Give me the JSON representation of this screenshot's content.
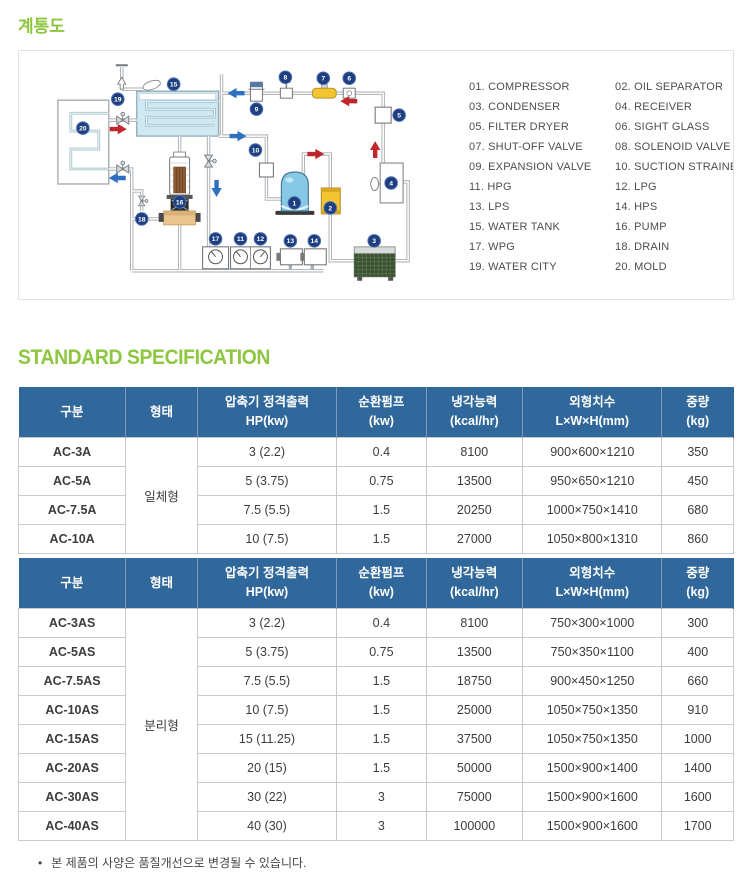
{
  "titles": {
    "diagram": "계통도",
    "spec": "STANDARD SPECIFICATION"
  },
  "colors": {
    "accent_green": "#8dc63f",
    "header_blue": "#31689b",
    "marker_navy": "#1d3f7f",
    "arrow_red": "#c0272d",
    "arrow_blue": "#2e6fc0"
  },
  "legend": {
    "items": [
      {
        "num": "01.",
        "label": "COMPRESSOR"
      },
      {
        "num": "02.",
        "label": "OIL SEPARATOR"
      },
      {
        "num": "03.",
        "label": "CONDENSER"
      },
      {
        "num": "04.",
        "label": "RECEIVER"
      },
      {
        "num": "05.",
        "label": "FILTER DRYER"
      },
      {
        "num": "06.",
        "label": "SIGHT GLASS"
      },
      {
        "num": "07.",
        "label": "SHUT-OFF VALVE"
      },
      {
        "num": "08.",
        "label": "SOLENOID VALVE"
      },
      {
        "num": "09.",
        "label": "EXPANSION VALVE"
      },
      {
        "num": "10.",
        "label": "SUCTION STRAINER"
      },
      {
        "num": "11.",
        "label": "HPG"
      },
      {
        "num": "12.",
        "label": "LPG"
      },
      {
        "num": "13.",
        "label": "LPS"
      },
      {
        "num": "14.",
        "label": "HPS"
      },
      {
        "num": "15.",
        "label": "WATER TANK"
      },
      {
        "num": "16.",
        "label": "PUMP"
      },
      {
        "num": "17.",
        "label": "WPG"
      },
      {
        "num": "18.",
        "label": "DRAIN"
      },
      {
        "num": "19.",
        "label": "WATER CITY"
      },
      {
        "num": "20.",
        "label": "MOLD"
      }
    ]
  },
  "spec": {
    "headers": [
      {
        "line1": "구분",
        "line2": ""
      },
      {
        "line1": "형태",
        "line2": ""
      },
      {
        "line1": "압축기 정격출력",
        "line2": "HP(kw)"
      },
      {
        "line1": "순환펌프",
        "line2": "(kw)"
      },
      {
        "line1": "냉각능력",
        "line2": "(kcal/hr)"
      },
      {
        "line1": "외형치수",
        "line2": "L×W×H(mm)"
      },
      {
        "line1": "중량",
        "line2": "(kg)"
      }
    ],
    "tables": [
      {
        "group": "일체형",
        "rows": [
          [
            "AC-3A",
            "3 (2.2)",
            "0.4",
            "8100",
            "900×600×1210",
            "350"
          ],
          [
            "AC-5A",
            "5 (3.75)",
            "0.75",
            "13500",
            "950×650×1210",
            "450"
          ],
          [
            "AC-7.5A",
            "7.5 (5.5)",
            "1.5",
            "20250",
            "1000×750×1410",
            "680"
          ],
          [
            "AC-10A",
            "10 (7.5)",
            "1.5",
            "27000",
            "1050×800×1310",
            "860"
          ]
        ]
      },
      {
        "group": "분리형",
        "rows": [
          [
            "AC-3AS",
            "3 (2.2)",
            "0.4",
            "8100",
            "750×300×1000",
            "300"
          ],
          [
            "AC-5AS",
            "5 (3.75)",
            "0.75",
            "13500",
            "750×350×1100",
            "400"
          ],
          [
            "AC-7.5AS",
            "7.5 (5.5)",
            "1.5",
            "18750",
            "900×450×1250",
            "660"
          ],
          [
            "AC-10AS",
            "10 (7.5)",
            "1.5",
            "25000",
            "1050×750×1350",
            "910"
          ],
          [
            "AC-15AS",
            "15 (11.25)",
            "1.5",
            "37500",
            "1050×750×1350",
            "1000"
          ],
          [
            "AC-20AS",
            "20 (15)",
            "1.5",
            "50000",
            "1500×900×1400",
            "1400"
          ],
          [
            "AC-30AS",
            "30 (22)",
            "3",
            "75000",
            "1500×900×1600",
            "1600"
          ],
          [
            "AC-40AS",
            "40 (30)",
            "3",
            "100000",
            "1500×900×1600",
            "1700"
          ]
        ]
      }
    ]
  },
  "note": {
    "bullet": "•",
    "text": "본 제품의 사양은 품질개선으로 변경될 수 있습니다."
  },
  "diagram": {
    "markers": [
      {
        "n": "1",
        "x": 276,
        "y": 152
      },
      {
        "n": "2",
        "x": 312,
        "y": 157
      },
      {
        "n": "3",
        "x": 356,
        "y": 190
      },
      {
        "n": "4",
        "x": 373,
        "y": 132
      },
      {
        "n": "5",
        "x": 381,
        "y": 64
      },
      {
        "n": "6",
        "x": 331,
        "y": 27
      },
      {
        "n": "7",
        "x": 305,
        "y": 27
      },
      {
        "n": "8",
        "x": 267,
        "y": 26
      },
      {
        "n": "9",
        "x": 238,
        "y": 58
      },
      {
        "n": "10",
        "x": 237,
        "y": 99
      },
      {
        "n": "11",
        "x": 222,
        "y": 188
      },
      {
        "n": "12",
        "x": 242,
        "y": 188
      },
      {
        "n": "13",
        "x": 272,
        "y": 190
      },
      {
        "n": "14",
        "x": 296,
        "y": 190
      },
      {
        "n": "15",
        "x": 155,
        "y": 33
      },
      {
        "n": "16",
        "x": 161,
        "y": 151
      },
      {
        "n": "17",
        "x": 197,
        "y": 188
      },
      {
        "n": "18",
        "x": 123,
        "y": 168
      },
      {
        "n": "19",
        "x": 99,
        "y": 48
      },
      {
        "n": "20",
        "x": 64,
        "y": 77
      }
    ]
  }
}
